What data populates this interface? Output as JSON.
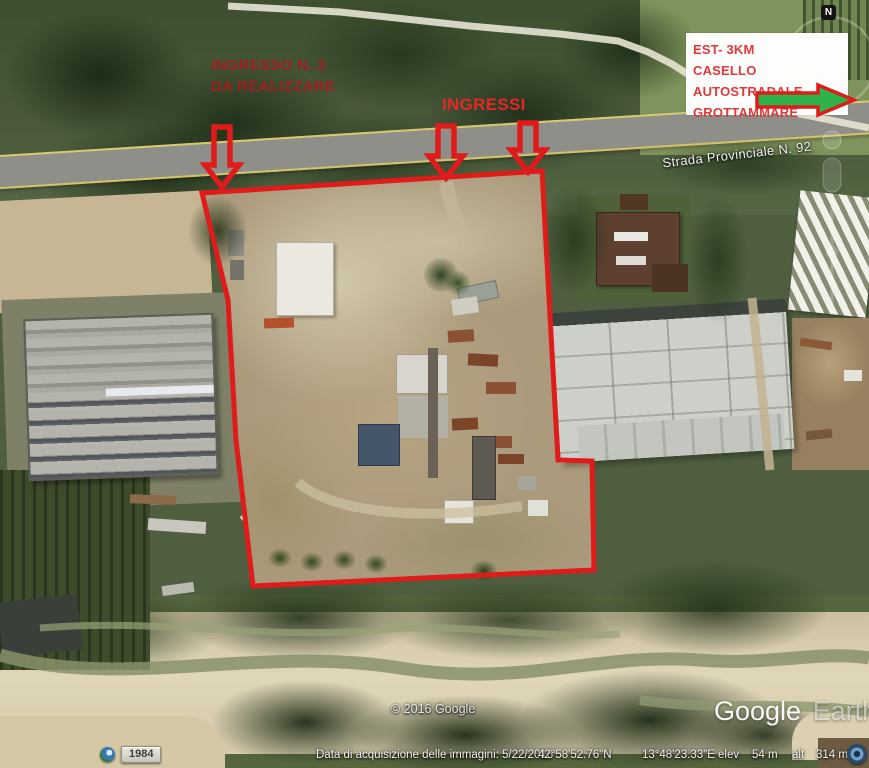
{
  "annotations": {
    "note": {
      "line1": "INGRESSO N. 3",
      "line2": "DA REALIZZARE"
    },
    "ingressi": "INGRESSI",
    "info_box": {
      "lines": [
        "EST- 3KM",
        "CASELLO AUTOSTRADALE",
        "GROTTAMMARE"
      ]
    }
  },
  "map": {
    "road_label": "Strada Provinciale N. 92",
    "compass": "N",
    "copyright": "© 2016 Google",
    "logo_primary": "Google",
    "logo_secondary": "Earth"
  },
  "status": {
    "year": "1984",
    "acquisition": "Data di acquisizione delle immagini: 5/22/2016",
    "lat": "42°58'52.76\"N",
    "lon": "13°48'23.33\"E",
    "elev_label": "elev",
    "elev_value": "54 m",
    "alt_label": "alt",
    "alt_value": "314 m"
  },
  "colors": {
    "annotation_red": "#e01b1b",
    "note_dark_red": "#a11f1f",
    "arrow_green": "#2eb34a",
    "road_yellow": "#d9c86e"
  }
}
